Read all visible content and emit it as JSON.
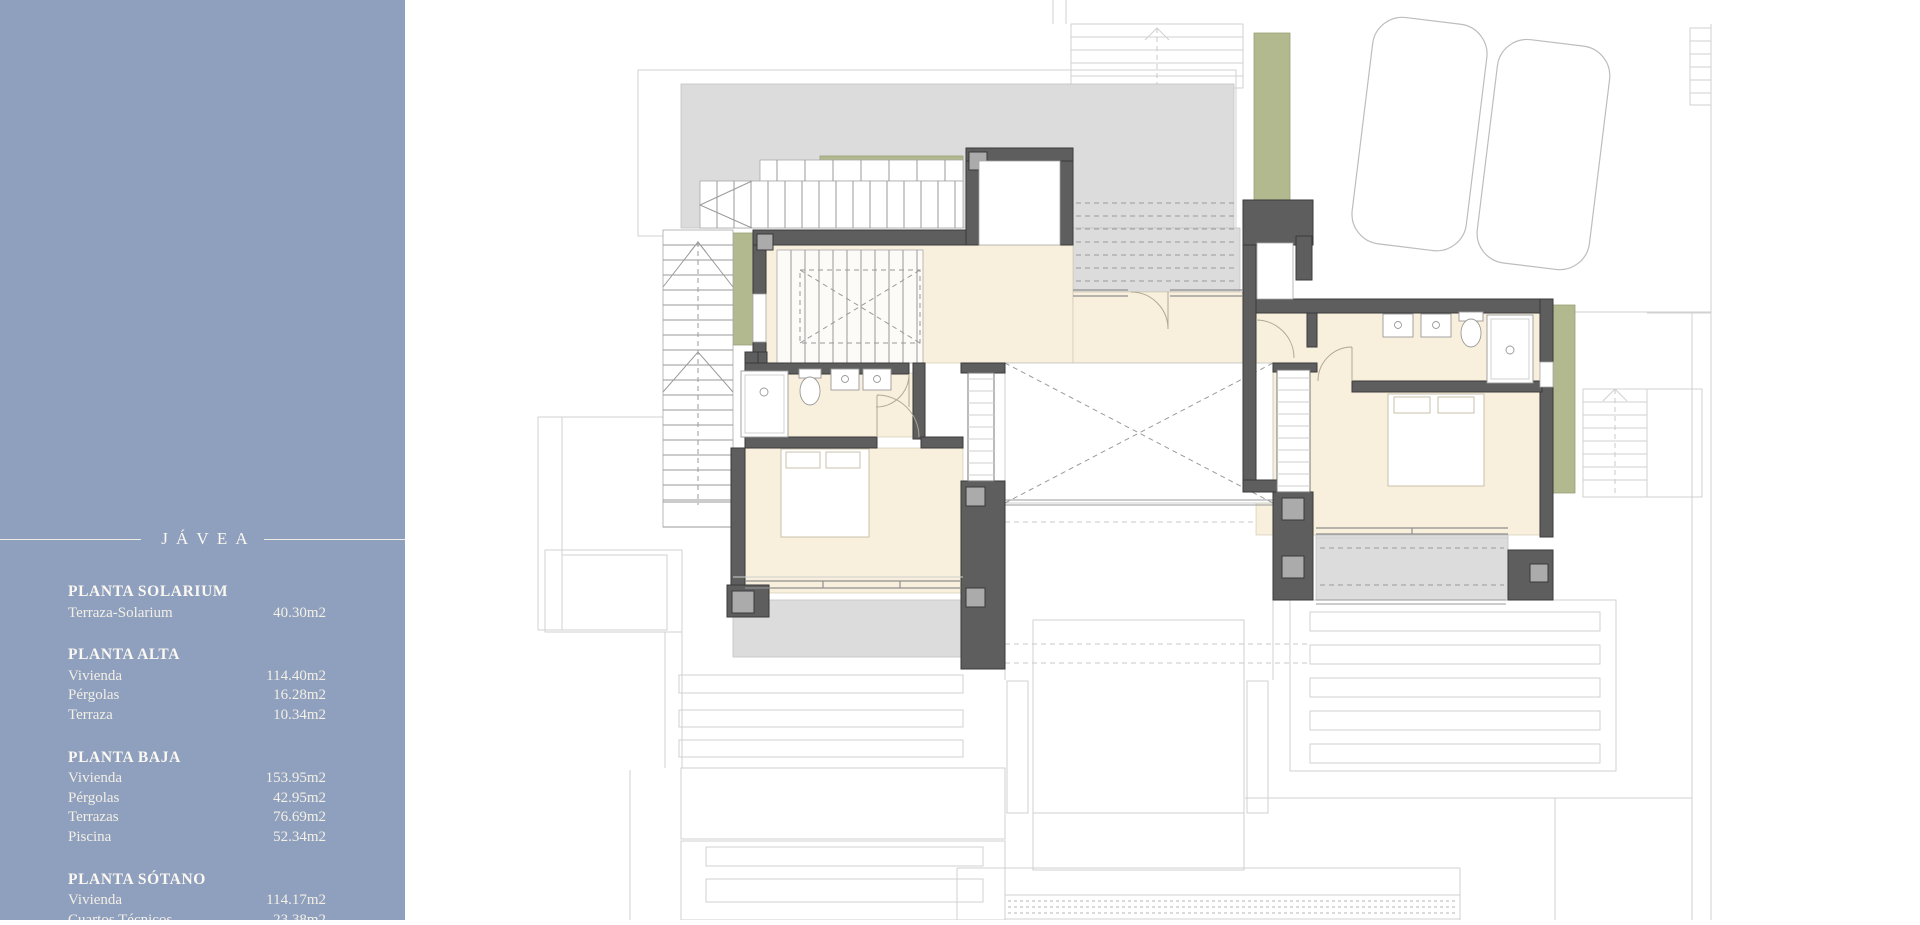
{
  "sidebar": {
    "background": "#8f9fbe",
    "text_color": "#f3f0e5",
    "title": "JÁVEA",
    "sections": [
      {
        "heading": "PLANTA SOLARIUM",
        "rows": [
          {
            "label": "Terraza-Solarium",
            "value": "40.30m2"
          }
        ]
      },
      {
        "heading": "PLANTA ALTA",
        "rows": [
          {
            "label": "Vivienda",
            "value": "114.40m2"
          },
          {
            "label": "Pérgolas",
            "value": "16.28m2"
          },
          {
            "label": "Terraza",
            "value": "10.34m2"
          }
        ]
      },
      {
        "heading": "PLANTA BAJA",
        "rows": [
          {
            "label": "Vivienda",
            "value": "153.95m2"
          },
          {
            "label": "Pérgolas",
            "value": "42.95m2"
          },
          {
            "label": "Terrazas",
            "value": "76.69m2"
          },
          {
            "label": "Piscina",
            "value": "52.34m2"
          }
        ]
      },
      {
        "heading": "PLANTA SÓTANO",
        "rows": [
          {
            "label": "Vivienda",
            "value": "114.17m2"
          },
          {
            "label": "Cuartos Técnicos",
            "value": "23.38m2"
          }
        ]
      }
    ]
  },
  "plan": {
    "description": "Upper floor (planta alta) architectural plan of villa in Jávea",
    "colors": {
      "walls": "#5e5e5e",
      "interior_floor": "#f8efdc",
      "terrace": "#dcdcdc",
      "planters": "#b2b98e",
      "columns": "#ababab",
      "site_lines": "#cfd2cf",
      "background": "#ffffff"
    }
  }
}
